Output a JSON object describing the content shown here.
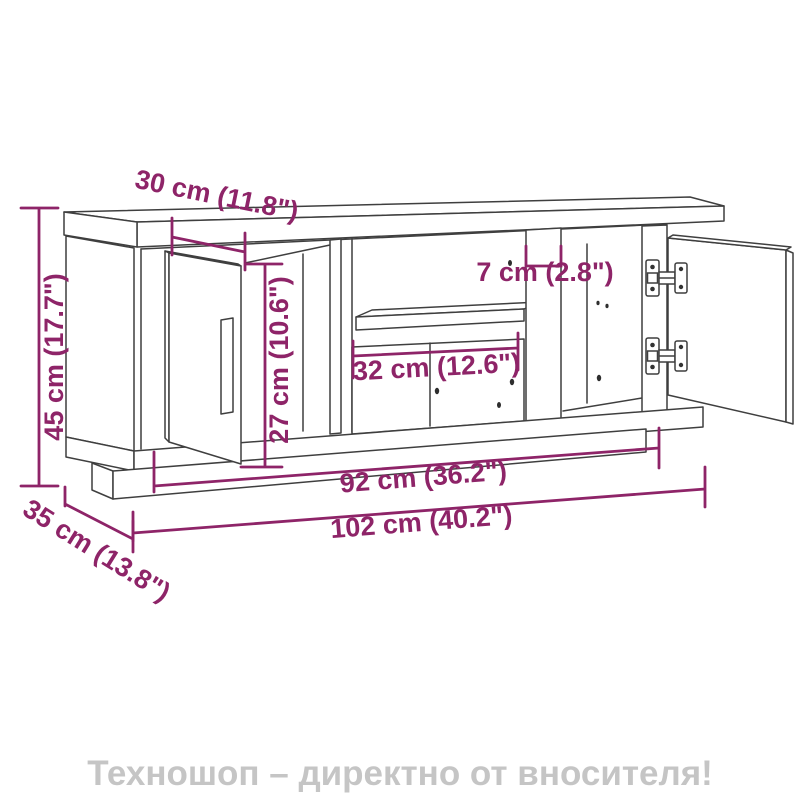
{
  "diagram": {
    "dimension_color": "#8E2468",
    "line_color": "#3F3F3F",
    "hole_color": "#2E2E2E",
    "dimensions": {
      "door_width": "30 cm (11.8\")",
      "height": "45 cm (17.7\")",
      "inner_height": "27 cm (10.6\")",
      "divider": "7 cm (2.8\")",
      "shelf_opening": "32 cm (12.6\")",
      "inner_width": "92 cm (36.2\")",
      "total_width": "102 cm (40.2\")",
      "depth": "35 cm (13.8\")"
    }
  },
  "footer": {
    "text": "Техношоп – директно от вносителя!",
    "color": "#C5C5C5"
  }
}
